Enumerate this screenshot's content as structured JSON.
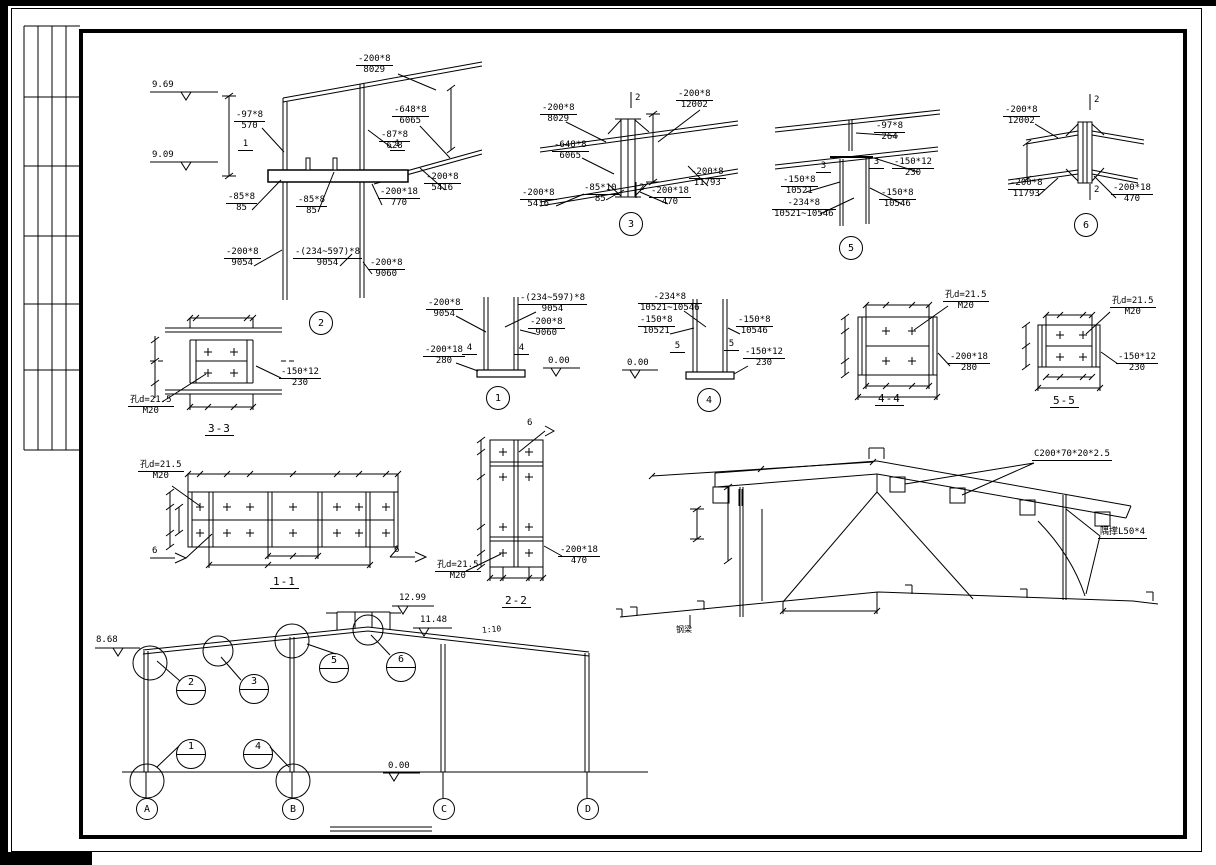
{
  "d": {
    "d2": {
      "bubble": "2",
      "sec": "1",
      "elev_top": "9.69",
      "elev_bot": "9.09",
      "c": [
        {
          "t": "-200*8",
          "b": "8029"
        },
        {
          "t": "-648*8",
          "b": "6065"
        },
        {
          "t": "-87*8",
          "b": "628"
        },
        {
          "t": "-97*8",
          "b": "570"
        },
        {
          "t": "-200*8",
          "b": "5416"
        },
        {
          "t": "-200*18",
          "b": "770"
        },
        {
          "t": "-85*8",
          "b": "85"
        },
        {
          "t": "-85*8",
          "b": "85"
        },
        {
          "t": "-200*8",
          "b": "9054"
        },
        {
          "t": "-(234~597)*8",
          "b": "9054"
        },
        {
          "t": "-200*8",
          "b": "9060"
        }
      ]
    },
    "d3": {
      "bubble": "3",
      "sec": "2",
      "c": [
        {
          "t": "-200*8",
          "b": "8029"
        },
        {
          "t": "-648*8",
          "b": "6065"
        },
        {
          "t": "-200*8",
          "b": "5416"
        },
        {
          "t": "-85*10",
          "b": "85"
        },
        {
          "t": "-200*8",
          "b": "12002"
        },
        {
          "t": "-200*8",
          "b": "11793"
        },
        {
          "t": "-200*18",
          "b": "470"
        }
      ]
    },
    "d5": {
      "bubble": "5",
      "sec": "3",
      "c": [
        {
          "t": "-97*8",
          "b": "264"
        },
        {
          "t": "-150*12",
          "b": "230"
        },
        {
          "t": "-150*8",
          "b": "10521"
        },
        {
          "t": "-234*8",
          "b": "10521~10546"
        },
        {
          "t": "-150*8",
          "b": "10546"
        }
      ]
    },
    "d6": {
      "bubble": "6",
      "sec": "2",
      "c": [
        {
          "t": "-200*8",
          "b": "12002"
        },
        {
          "t": "-200*8",
          "b": "11793"
        },
        {
          "t": "-200*18",
          "b": "470"
        }
      ]
    },
    "d33": {
      "title": "3-3",
      "c": [
        {
          "t": "孔d=21.5",
          "b": "M20"
        },
        {
          "t": "-150*12",
          "b": "230"
        }
      ]
    },
    "d1": {
      "bubble": "1",
      "sec": "4",
      "zero": "0.00",
      "c": [
        {
          "t": "-200*8",
          "b": "9054"
        },
        {
          "t": "-(234~597)*8",
          "b": "9054"
        },
        {
          "t": "-200*8",
          "b": "9060"
        },
        {
          "t": "-200*18",
          "b": "280"
        }
      ]
    },
    "d4": {
      "bubble": "4",
      "sec": "5",
      "zero": "0.00",
      "c": [
        {
          "t": "-234*8",
          "b": "10521~10546"
        },
        {
          "t": "-150*8",
          "b": "10521"
        },
        {
          "t": "-150*8",
          "b": "10546"
        },
        {
          "t": "-150*12",
          "b": "230"
        }
      ]
    },
    "d44": {
      "title": "4-4",
      "c": [
        {
          "t": "孔d=21.5",
          "b": "M20"
        },
        {
          "t": "-200*18",
          "b": "280"
        }
      ]
    },
    "d55": {
      "title": "5-5",
      "c": [
        {
          "t": "孔d=21.5",
          "b": "M20"
        },
        {
          "t": "-150*12",
          "b": "230"
        }
      ]
    },
    "d11": {
      "title": "1-1",
      "weld": "6",
      "c": [
        {
          "t": "孔d=21.5",
          "b": "M20"
        }
      ]
    },
    "d22": {
      "title": "2-2",
      "weld": "6",
      "c": [
        {
          "t": "-200*18",
          "b": "470"
        },
        {
          "t": "孔d=21.5",
          "b": "M20"
        }
      ]
    }
  },
  "rd": {
    "purlin": "C200*70*20*2.5",
    "brace": "隅撑L50*4",
    "beam": "钢梁"
  },
  "el": {
    "levels": {
      "eave": "8.68",
      "ridge_top": "12.99",
      "ridge": "11.48",
      "ground": "0.00"
    },
    "slope": "1:10",
    "callouts": [
      "1",
      "2",
      "3",
      "4",
      "5",
      "6"
    ],
    "grids": [
      "A",
      "B",
      "C",
      "D"
    ]
  }
}
